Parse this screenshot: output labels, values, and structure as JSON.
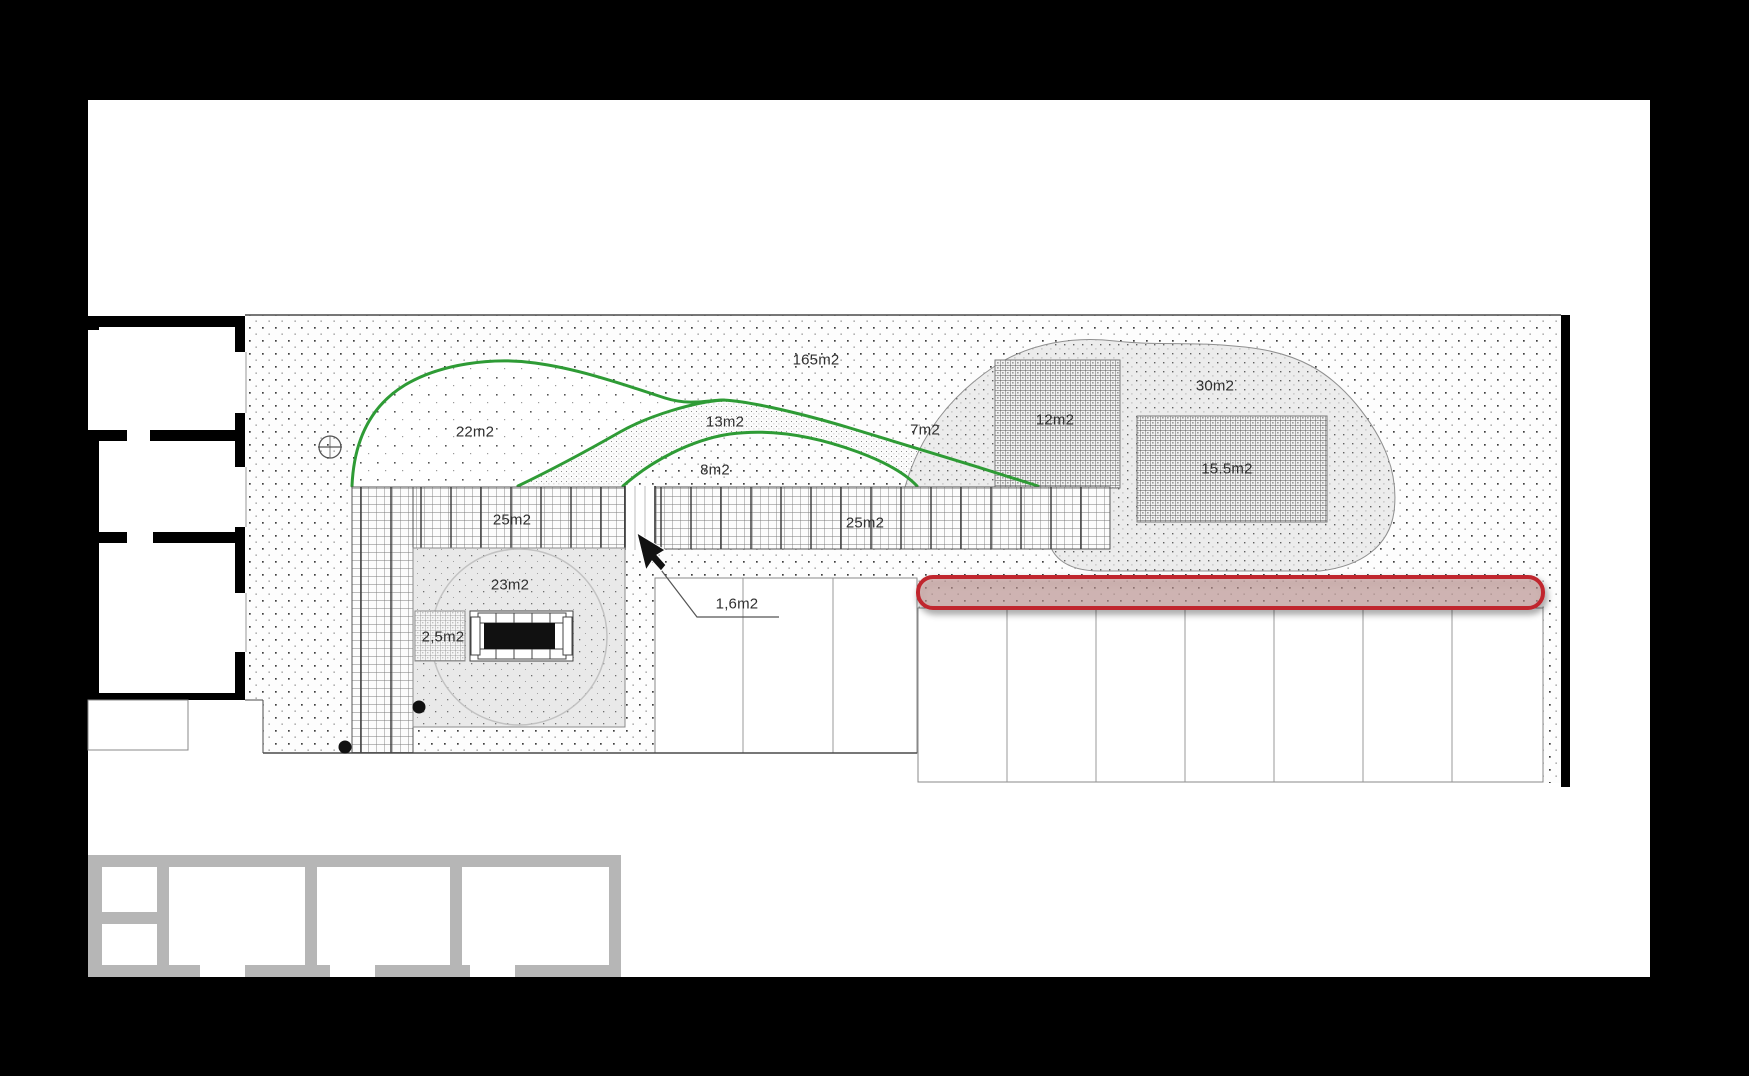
{
  "plan": {
    "area_labels": [
      {
        "name": "lawn-total",
        "text": "165m2"
      },
      {
        "name": "planting-bed-left",
        "text": "22m2"
      },
      {
        "name": "path-band-upper",
        "text": "13m2"
      },
      {
        "name": "path-band-right",
        "text": "7m2"
      },
      {
        "name": "path-band-lower",
        "text": "8m2"
      },
      {
        "name": "gravel-area",
        "text": "30m2"
      },
      {
        "name": "hatch-square-upper",
        "text": "12m2"
      },
      {
        "name": "hatch-square-lower",
        "text": "15.5m2"
      },
      {
        "name": "deck-left",
        "text": "25m2"
      },
      {
        "name": "deck-right",
        "text": "25m2"
      },
      {
        "name": "patio-square",
        "text": "23m2"
      },
      {
        "name": "passage",
        "text": "1,6m2"
      },
      {
        "name": "planter",
        "text": "2,5m2"
      }
    ],
    "highlight": {
      "shape": "rounded-rectangle",
      "border_color": "#c0272d",
      "fill_color": "rgba(197,153,151,0.55)"
    },
    "colors": {
      "planting_outline": "#2e9b35",
      "building_wall": "#000000",
      "secondary_building_wall": "#b6b6b6",
      "page_background": "#ffffff",
      "screen_background": "#000000"
    }
  }
}
